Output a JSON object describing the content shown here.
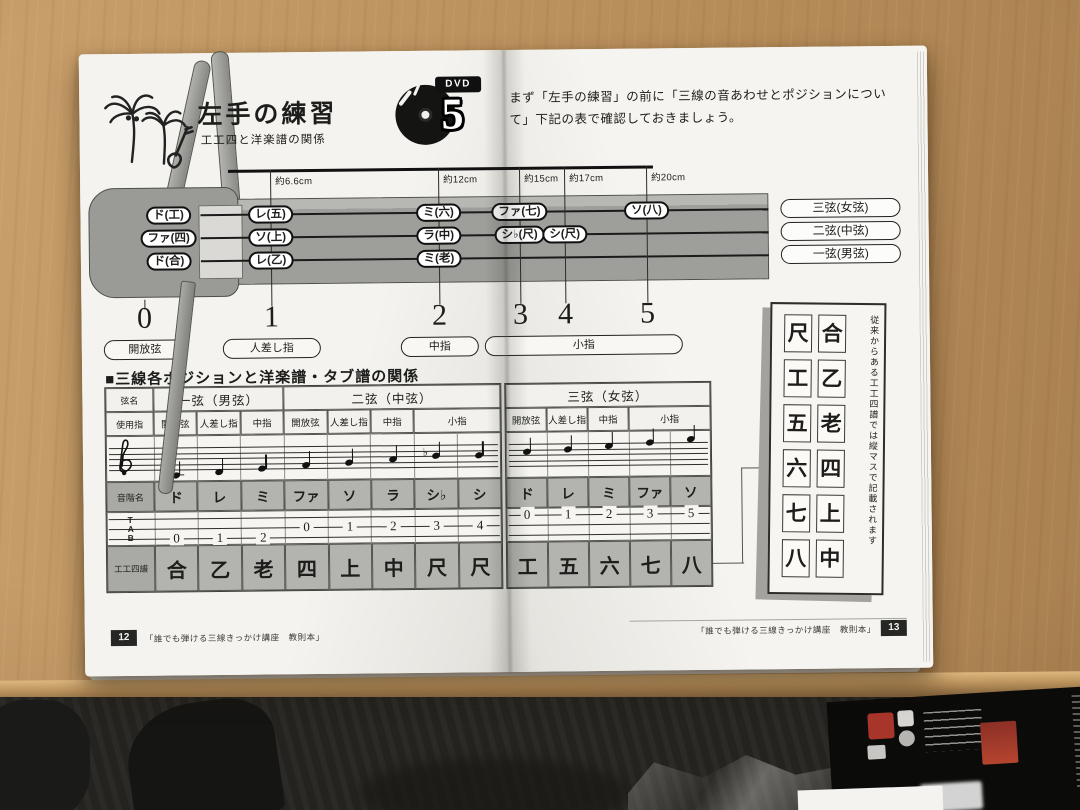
{
  "scene": {
    "desk_color": "#bf9662",
    "floor_color": "#24231f",
    "accent_red": "#a8352a"
  },
  "left_page": {
    "title": "左手の練習",
    "subtitle": "工工四と洋楽譜の関係",
    "dvd": {
      "label": "DVD",
      "number": "5"
    },
    "footer": {
      "page_num": "12",
      "text": "「誰でも弾ける三線きっかけ講座　教則本」"
    }
  },
  "right_page": {
    "intro": "まず「左手の練習」の前に「三線の音あわせとポジションについて」下記の表で確認しておきましょう。",
    "footer": {
      "page_num": "13",
      "text": "「誰でも弾ける三線きっかけ講座　教則本」"
    },
    "sidebar_box": {
      "caption": "従来からある工工四譜では縦マスで記載されます",
      "column_right": [
        "合",
        "乙",
        "老",
        "四",
        "上",
        "中"
      ],
      "column_left": [
        "尺",
        "工",
        "五",
        "六",
        "七",
        "八"
      ]
    }
  },
  "neck_diagram": {
    "measurements": [
      "約6.6cm",
      "約12cm",
      "約15cm",
      "約17cm",
      "約20cm"
    ],
    "headstock_notes": [
      "ド(工)",
      "ファ(四)",
      "ド(合)"
    ],
    "fretted_notes": [
      {
        "text": "レ(五)",
        "position": 1,
        "string": 1
      },
      {
        "text": "ソ(上)",
        "position": 1,
        "string": 2
      },
      {
        "text": "レ(乙)",
        "position": 1,
        "string": 3
      },
      {
        "text": "ミ(六)",
        "position": 2,
        "string": 1
      },
      {
        "text": "ラ(中)",
        "position": 2,
        "string": 2
      },
      {
        "text": "ミ(老)",
        "position": 2,
        "string": 3
      },
      {
        "text": "ファ(七)",
        "position": 3,
        "string": 1
      },
      {
        "text": "シ♭(尺)",
        "position": 3,
        "string": 2
      },
      {
        "text": "シ(尺)",
        "position": 4,
        "string": 2
      },
      {
        "text": "ソ(八)",
        "position": 5,
        "string": 1
      }
    ],
    "string_labels": [
      "三弦(女弦)",
      "二弦(中弦)",
      "一弦(男弦)"
    ],
    "position_numbers": [
      "0",
      "1",
      "2",
      "3",
      "4",
      "5"
    ],
    "finger_labels": [
      "開放弦",
      "人差し指",
      "中指",
      "小指"
    ]
  },
  "position_table": {
    "title": "■三線各ポジションと洋楽譜・タブ譜の関係",
    "row_headers": {
      "string_name": "弦名",
      "finger": "使用指",
      "scale": "音階名",
      "tab": "TAB",
      "kunkunshi": "工工四譜"
    },
    "left": {
      "groups": [
        {
          "label": "一弦（男弦）",
          "colspan": 3
        },
        {
          "label": "二弦（中弦）",
          "colspan": 5
        }
      ],
      "fingers": [
        {
          "label": "開放弦",
          "span": 1
        },
        {
          "label": "人差し指",
          "span": 1
        },
        {
          "label": "中指",
          "span": 1
        },
        {
          "label": "開放弦",
          "span": 1
        },
        {
          "label": "人差し指",
          "span": 1
        },
        {
          "label": "中指",
          "span": 1
        },
        {
          "label": "小指",
          "span": 2
        }
      ],
      "notes": [
        "ド",
        "レ",
        "ミ",
        "ファ",
        "ソ",
        "ラ",
        "シ♭",
        "シ"
      ],
      "staff_steps": [
        -2,
        -1,
        0,
        1,
        2,
        3,
        4,
        4
      ],
      "tab_values": [
        "0",
        "1",
        "2",
        "0",
        "1",
        "2",
        "3",
        "4"
      ],
      "tab_strings": [
        3,
        3,
        3,
        2,
        2,
        2,
        2,
        2
      ],
      "kunkunshi": [
        "合",
        "乙",
        "老",
        "四",
        "上",
        "中",
        "尺",
        "尺"
      ]
    },
    "right": {
      "groups": [
        {
          "label": "三弦（女弦）",
          "colspan": 5
        }
      ],
      "fingers": [
        {
          "label": "開放弦",
          "span": 1
        },
        {
          "label": "人差し指",
          "span": 1
        },
        {
          "label": "中指",
          "span": 1
        },
        {
          "label": "小指",
          "span": 2
        }
      ],
      "notes": [
        "ド",
        "レ",
        "ミ",
        "ファ",
        "ソ"
      ],
      "staff_steps": [
        5,
        6,
        7,
        8,
        9
      ],
      "tab_values": [
        "0",
        "1",
        "2",
        "3",
        "5"
      ],
      "tab_strings": [
        1,
        1,
        1,
        1,
        1
      ],
      "kunkunshi": [
        "工",
        "五",
        "六",
        "七",
        "八"
      ]
    }
  }
}
